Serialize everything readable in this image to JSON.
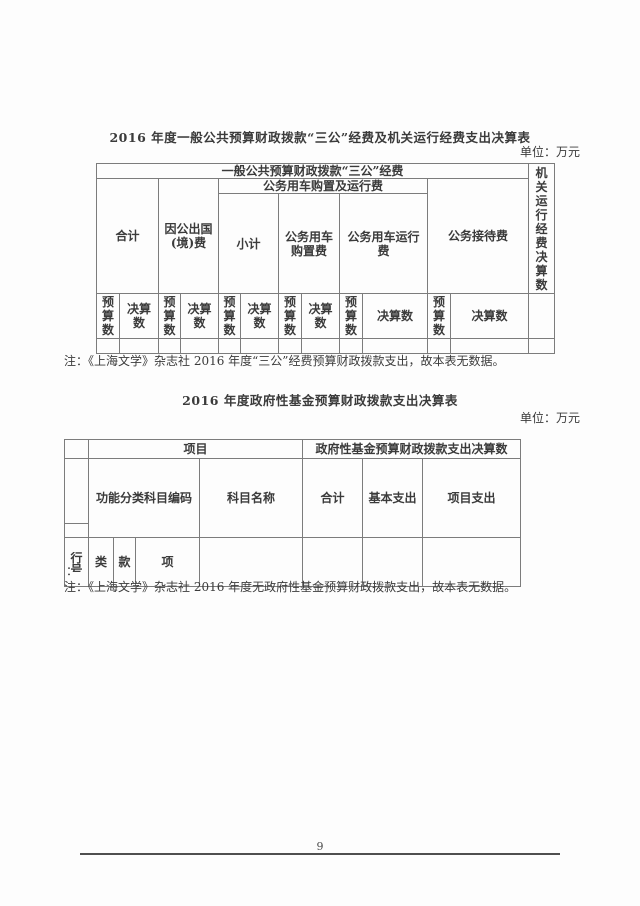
{
  "page": {
    "page_number": "9",
    "unit_label": "单位：万元"
  },
  "table1": {
    "title": "2016 年度一般公共预算财政拨款“三公”经费及机关运行经费支出决算表",
    "headers": {
      "general_budget": "一般公共预算财政拨款“三公”经费",
      "agency_operating_vertical": "机\n关\n运\n行\n经\n费\n决\n算\n数",
      "total": "合计",
      "abroad": "因公出国\n(境)费",
      "vehicle_group": "公务用车购置及运行费",
      "subtotal": "小计",
      "vehicle_purchase": "公务用车\n购置费",
      "vehicle_operation": "公务用车运行\n费",
      "reception": "公务接待费",
      "budget_narrow": "预\n算\n数",
      "final_narrow": "决算\n数",
      "final_wide": "决算数"
    },
    "note": "注：《上海文学》杂志社 2016 年度“三公”经费预算财政拨款支出，故本表无数据。"
  },
  "table2": {
    "title": "2016 年度政府性基金预算财政拨款支出决算表",
    "headers": {
      "project": "项目",
      "fund_final": "政府性基金预算财政拨款支出决算数",
      "function_code": "功能分类科目编码",
      "subject_name": "科目名称",
      "total": "合计",
      "basic_expense": "基本支出",
      "project_expense": "项目支出",
      "row_number": "行\n号",
      "category": "类",
      "clause": "款",
      "item": "项"
    },
    "stray_colon": "：",
    "note": "注：《上海文学》杂志社 2016 年度无政府性基金预算财政拨款支出，故本表无数据。"
  }
}
